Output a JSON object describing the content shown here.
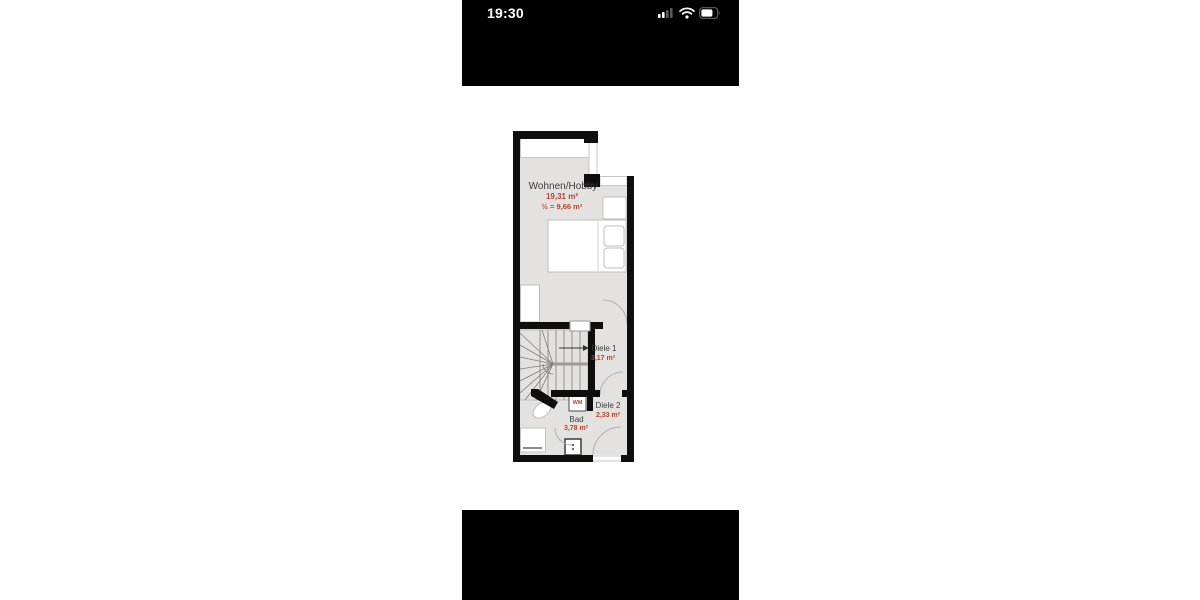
{
  "status_bar": {
    "time": "19:30",
    "icons": [
      {
        "name": "cellular-signal-icon",
        "state": "2 of 4 bars"
      },
      {
        "name": "wifi-icon",
        "state": "on"
      },
      {
        "name": "battery-icon",
        "state": "about two-thirds full"
      }
    ]
  },
  "floor_plan": {
    "rooms": [
      {
        "id": "wohnen",
        "name": "Wohnen/Hobby",
        "area": "19,31 m²",
        "area_note": "½ = 9,66 m²"
      },
      {
        "id": "diele1",
        "name": "Diele 1",
        "area": "3,17 m²"
      },
      {
        "id": "diele2",
        "name": "Diele 2",
        "area": "2,33 m²"
      },
      {
        "id": "bad",
        "name": "Bad",
        "area": "3,78 m²"
      }
    ],
    "appliances": {
      "washing_machine": "WM"
    },
    "colors": {
      "wall": "#0e0e0e",
      "floor": "#e4e2e0",
      "room_label": "#3c3c3c",
      "area_label": "#b5442e",
      "furniture_fill": "#ffffff",
      "door_arc": "#b0b0b0"
    }
  }
}
